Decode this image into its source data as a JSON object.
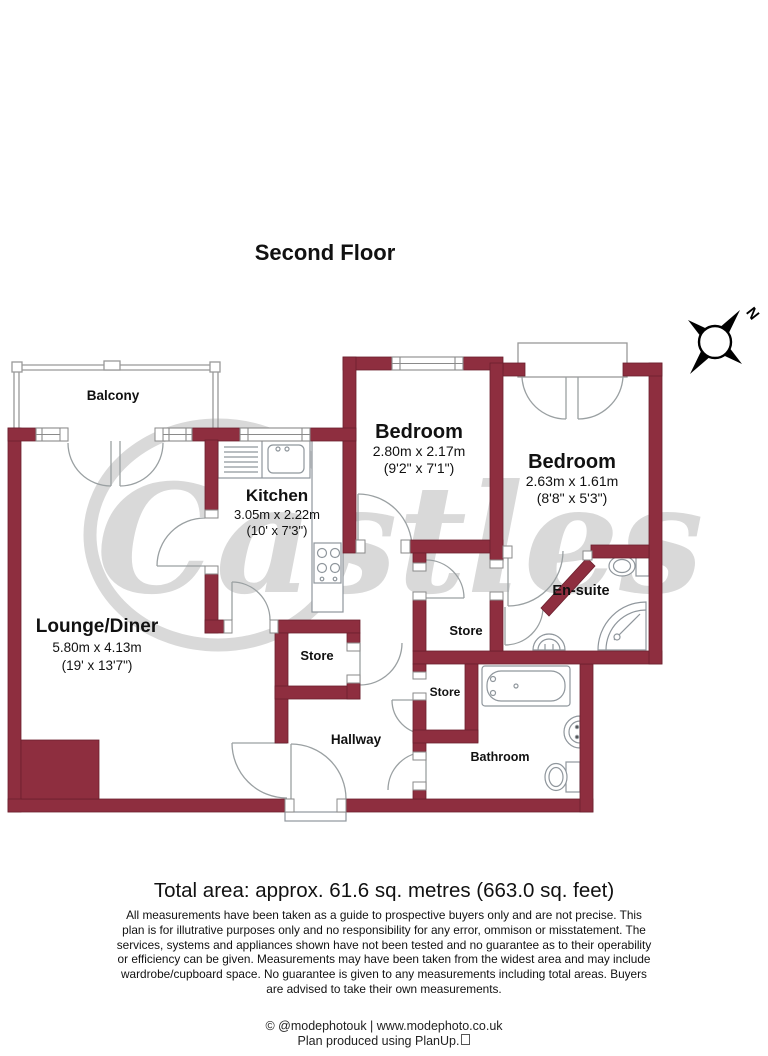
{
  "header": {
    "title": "Second Floor"
  },
  "compass": {
    "label": "N"
  },
  "watermark": {
    "text": "Castles"
  },
  "rooms": {
    "balcony": {
      "name": "Balcony"
    },
    "lounge": {
      "name": "Lounge/Diner",
      "metric": "5.80m x 4.13m",
      "imperial": "(19' x 13'7\")"
    },
    "kitchen": {
      "name": "Kitchen",
      "metric": "3.05m x 2.22m",
      "imperial": "(10' x 7'3\")"
    },
    "bedroom1": {
      "name": "Bedroom",
      "metric": "2.80m x 2.17m",
      "imperial": "(9'2\" x 7'1\")"
    },
    "bedroom2": {
      "name": "Bedroom",
      "metric": "2.63m x 1.61m",
      "imperial": "(8'8\" x 5'3\")"
    },
    "ensuite": {
      "name": "En-suite"
    },
    "store_left": {
      "name": "Store"
    },
    "store_mid": {
      "name": "Store"
    },
    "store_small": {
      "name": "Store"
    },
    "hallway": {
      "name": "Hallway"
    },
    "bathroom": {
      "name": "Bathroom"
    }
  },
  "summary": {
    "total_area": "Total area: approx. 61.6 sq. metres (663.0 sq. feet)"
  },
  "disclaimer": {
    "text": "All measurements have been taken as a guide to prospective buyers only and are not precise. This plan is for illutrative purposes only and no responsibility for any error, ommison or misstatement. The services, systems and appliances shown have not been tested and no guarantee as to their operability or efficiency can be given. Measurements may have been taken from the widest area and may include wardrobe/cupboard space. No guarantee is given to any measurements including total areas. Buyers are advised to take their own measurements."
  },
  "footer": {
    "credit": "© @modephotouk | www.modephoto.co.uk",
    "produced": "Plan produced using PlanUp."
  },
  "colors": {
    "wall": "#8e2e3f",
    "wall_outline": "#6b202e",
    "fixture_line": "#8f969c",
    "watermark": "#d9d9d9"
  }
}
